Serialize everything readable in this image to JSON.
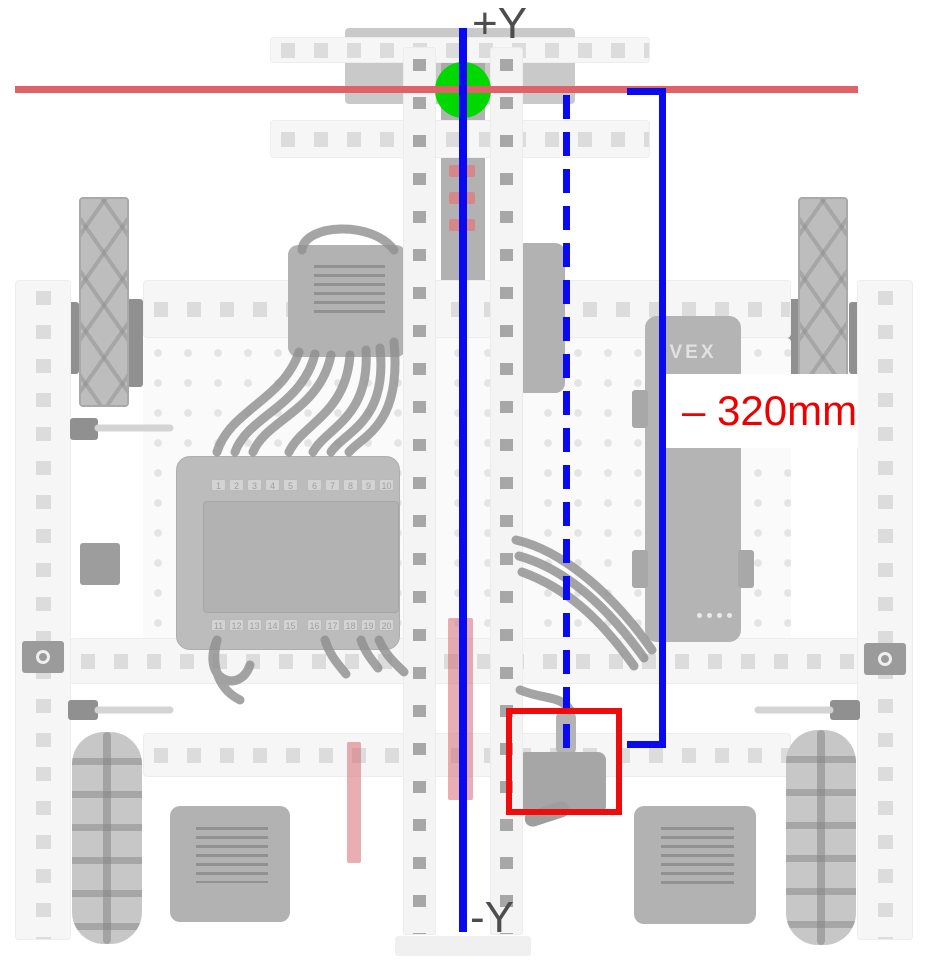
{
  "colors": {
    "axis_blue": "#0a0af0",
    "line_red": "#e06167",
    "origin_green": "#00d900",
    "highlight_red": "#ee0c0c",
    "measure_red": "#ee0000",
    "label_gray": "#4d4d4d"
  },
  "axis": {
    "top_label": "+Y",
    "bottom_label": "-Y"
  },
  "measurement": {
    "label": "– 320mm"
  },
  "battery": {
    "logo": "VEX"
  },
  "brain": {
    "ports_top": [
      "1",
      "2",
      "3",
      "4",
      "5",
      "6",
      "7",
      "8",
      "9",
      "10"
    ],
    "ports_bottom": [
      "11",
      "12",
      "13",
      "14",
      "15",
      "16",
      "17",
      "18",
      "19",
      "20"
    ]
  }
}
